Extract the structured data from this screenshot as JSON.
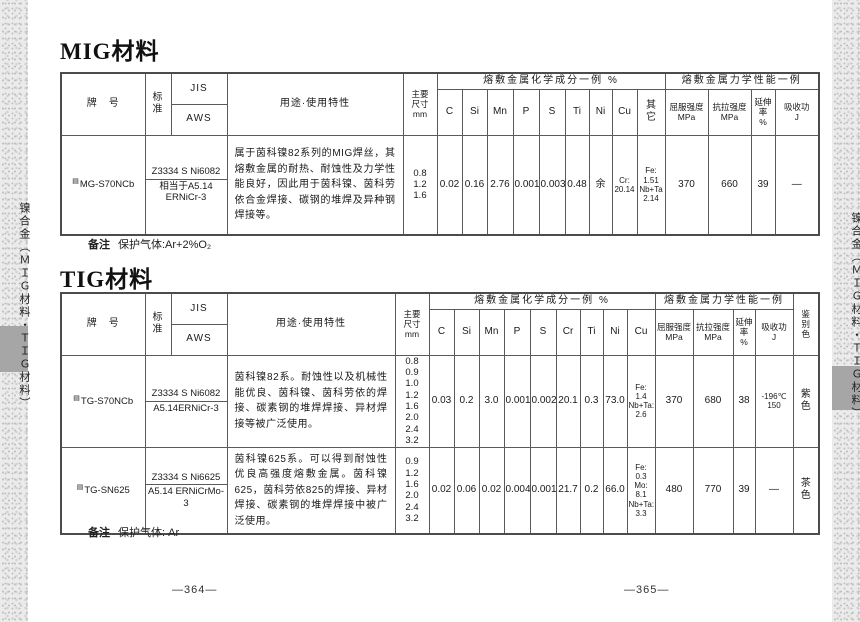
{
  "sidebar": {
    "label": "镍合金（ＭＩＧ材料・ＴＩＧ材料）"
  },
  "page": {
    "left_page_number": "—364—",
    "right_page_number": "—365—"
  },
  "mig": {
    "title": "MIG材料",
    "header": {
      "brand": "牌　号",
      "standard": "标\n准",
      "jis": "JIS",
      "aws": "AWS",
      "usage": "用途·使用特性",
      "size": "主要\n尺寸\nmm",
      "chem_group": "熔敷金属化学成分一例 %",
      "mech_group": "熔敷金属力学性能一例",
      "chem_cols": [
        "C",
        "Si",
        "Mn",
        "P",
        "S",
        "Ti",
        "Ni",
        "Cu",
        "其\n它"
      ],
      "mech_cols": [
        "屈服强度\nMPa",
        "抗拉强度\nMPa",
        "延伸\n率\n%",
        "吸收功\nJ"
      ]
    },
    "rows": [
      {
        "mark": "▤",
        "brand": "MG-S70NCb",
        "jis": "Z3334 S Ni6082",
        "aws": "相当于A5.14\nERNiCr-3",
        "usage": "属于茵科镍82系列的MIG焊丝，其熔敷金属的耐热、耐蚀性及力学性能良好，因此用于茵科镍、茵科劳依合金焊接、碳钢的堆焊及异种钢焊接等。",
        "sizes": "0.8\n1.2\n1.6",
        "chem": [
          "0.02",
          "0.16",
          "2.76",
          "0.001",
          "0.003",
          "0.48",
          "余",
          "Cr:\n20.14",
          "Fe:\n1.51\nNb+Ta\n2.14"
        ],
        "mech": [
          "370",
          "660",
          "39",
          "—"
        ]
      }
    ],
    "note_label": "备注",
    "note": "保护气体:Ar+2%O₂"
  },
  "tig": {
    "title": "TIG材料",
    "header": {
      "brand": "牌　号",
      "standard": "标\n准",
      "jis": "JIS",
      "aws": "AWS",
      "usage": "用途·使用特性",
      "size": "主要\n尺寸\nmm",
      "chem_group": "熔敷金属化学成分一例 %",
      "mech_group": "熔敷金属力学性能一例",
      "chem_cols": [
        "C",
        "Si",
        "Mn",
        "P",
        "S",
        "Cr",
        "Ti",
        "Ni",
        "Cu"
      ],
      "mech_cols": [
        "屈服强度\nMPa",
        "抗拉强度\nMPa",
        "延伸\n率\n%",
        "吸收功\nJ"
      ],
      "color": "鉴\n别\n色"
    },
    "rows": [
      {
        "mark": "▤",
        "brand": "TG-S70NCb",
        "jis": "Z3334 S Ni6082",
        "aws": "A5.14ERNiCr-3",
        "usage": "茵科镍82系。耐蚀性以及机械性能优良、茵科镍、茵科劳依的焊接、碳素钢的堆焊焊接、异材焊接等被广泛使用。",
        "sizes": "0.8\n0.9\n1.0\n1.2\n1.6\n2.0\n2.4\n3.2",
        "chem": [
          "0.03",
          "0.2",
          "3.0",
          "0.001",
          "0.002",
          "20.1",
          "0.3",
          "73.0",
          "Fe:\n1.4\nNb+Ta:\n2.6"
        ],
        "mech": [
          "370",
          "680",
          "38",
          "-196℃\n150"
        ],
        "color": "紫\n色"
      },
      {
        "mark": "▤",
        "brand": "TG-SN625",
        "jis": "Z3334 S Ni6625",
        "aws": "A5.14 ERNiCrMo-3",
        "usage": "茵科镍625系。可以得到耐蚀性优良高强度熔敷金属。茵科镍625，茵科劳依825的焊接、异材焊接、碳素钢的堆焊焊接中被广泛使用。",
        "sizes": "0.9\n1.2\n1.6\n2.0\n2.4\n3.2",
        "chem": [
          "0.02",
          "0.06",
          "0.02",
          "0.004",
          "0.001",
          "21.7",
          "0.2",
          "66.0",
          "Fe:\n0.3\nMo:\n8.1\nNb+Ta:\n3.3"
        ],
        "mech": [
          "480",
          "770",
          "39",
          "—"
        ],
        "color": "茶\n色"
      }
    ],
    "note_label": "备注",
    "note": "保护气体: Ar"
  }
}
